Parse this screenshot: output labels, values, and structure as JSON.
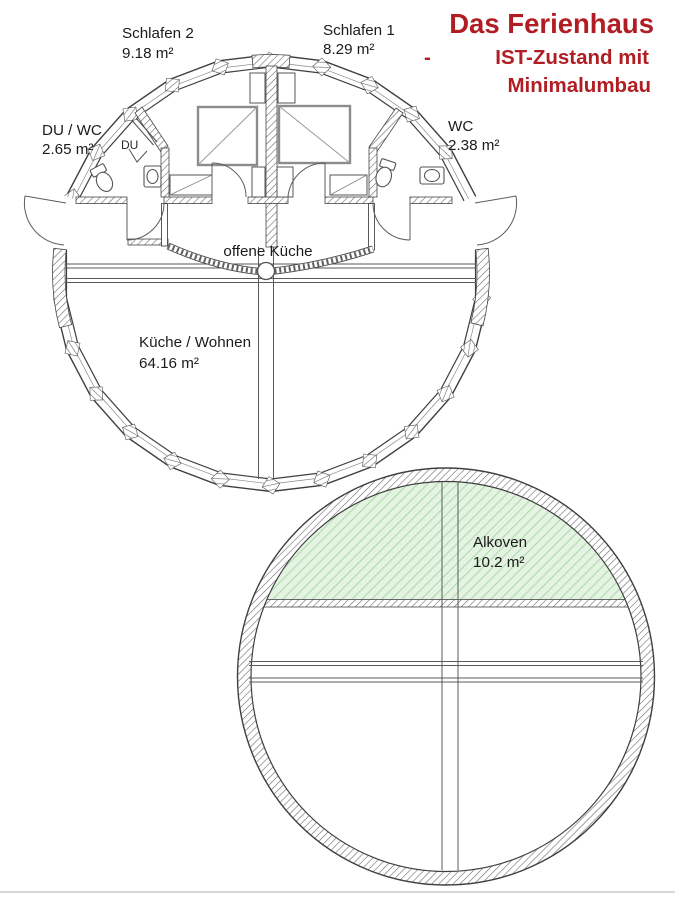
{
  "title": {
    "heading": "Das Ferienhaus",
    "dash": "-",
    "line1": "IST-Zustand mit",
    "line2": "Minimalumbau"
  },
  "colors": {
    "accent_red": "#b01e24",
    "alkoven_green": "#aed9ae",
    "wall_line": "#474747"
  },
  "upper_plan": {
    "rooms": [
      {
        "id": "schlafen2",
        "label": "Schlafen 2",
        "area": "9.18 m²"
      },
      {
        "id": "schlafen1",
        "label": "Schlafen 1",
        "area": "8.29 m²"
      },
      {
        "id": "du_wc",
        "label": "DU / WC",
        "area": "2.65 m²"
      },
      {
        "id": "wc",
        "label": "WC",
        "area": "2.38 m²"
      },
      {
        "id": "kueche_wohnen",
        "label": "Küche / Wohnen",
        "area": "64.16 m²"
      }
    ],
    "annotations": [
      {
        "id": "offene_kueche",
        "label": "offene Küche"
      },
      {
        "id": "dusche",
        "label": "DU"
      }
    ]
  },
  "lower_plan": {
    "rooms": [
      {
        "id": "alkoven",
        "label": "Alkoven",
        "area": "10.2 m²"
      }
    ]
  }
}
